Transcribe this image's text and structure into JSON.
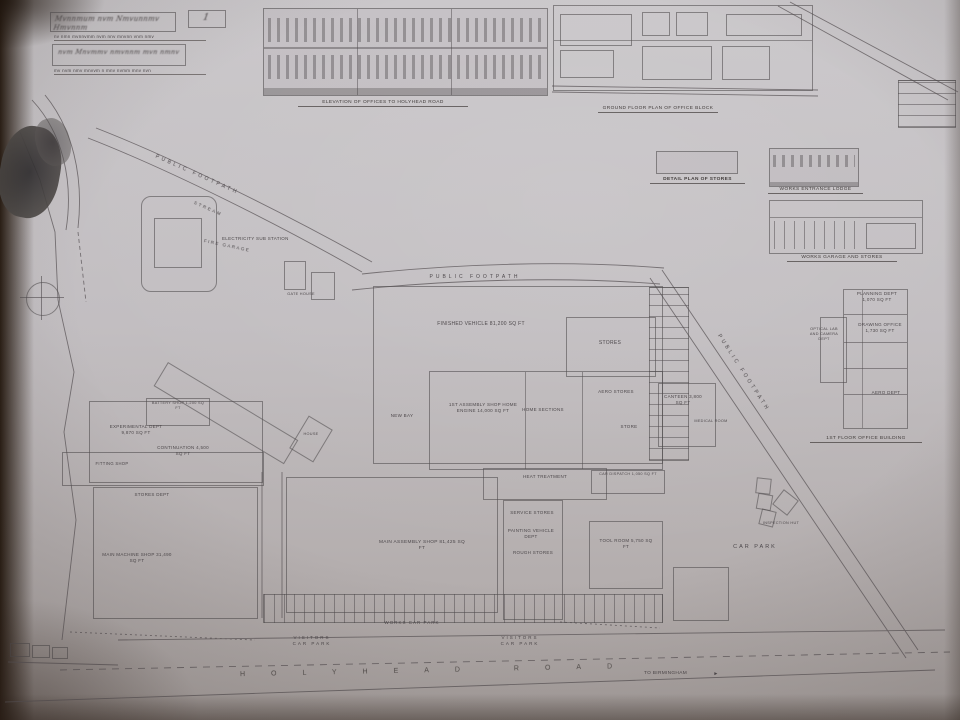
{
  "title_block": {
    "sheet_number": "1",
    "scribble1": "Mvnnmum nvm Nmvunnmv Hmvnnm",
    "typed1": "nv nmn mvnnvmm nvm nnv mnvnn vnm nmv",
    "scribble2": "nvm Mnvmmv nmvnnm mvn nmnv",
    "typed2": "mv nvm nmv mnvvm n mnv nvmm mnv nvn"
  },
  "captions": {
    "elevation": "ELEVATION OF OFFICES TO HOLYHEAD ROAD",
    "ground_plan": "GROUND FLOOR PLAN OF OFFICE BLOCK",
    "stores_shed": "DETAIL PLAN OF STORES",
    "lodge": "WORKS ENTRANCE LODGE",
    "garage": "WORKS GARAGE AND STORES",
    "first_floor": "1ST FLOOR OFFICE BUILDING"
  },
  "right_plan": {
    "planning": "PLANNING DEPT 1,070 SQ FT",
    "drawing_office": "DRAWING OFFICE 1,730 SQ FT",
    "optical": "OPTICAL LAB AND CAMERA DEPT",
    "aero_dept": "AERO DEPT"
  },
  "roads": {
    "holyhead": "HOLYHEAD ROAD",
    "to_birmingham": "TO BIRMINGHAM"
  },
  "paths": {
    "footpath1": "PUBLIC FOOTPATH",
    "footpath2": "PUBLIC FOOTPATH",
    "footpath3": "PUBLIC FOOTPATH",
    "stream": "STREAM"
  },
  "labels": {
    "sub_station": "ELECTRICITY SUB STATION",
    "fire_garage": "FIRE GARAGE",
    "gate_house": "GATE HOUSE",
    "house": "HOUSE",
    "new_bay": "NEW BAY",
    "finished_vehicle": "FINISHED VEHICLE 81,200 SQ FT",
    "stores": "STORES",
    "assembly": "1ST ASSEMBLY SHOP HOME ENGINE 14,000 SQ FT",
    "home_sections": "HOME SECTIONS",
    "aero_stores": "AERO STORES",
    "store": "STORE",
    "canteen": "CANTEEN 3,800 SQ FT",
    "medical": "MEDICAL ROOM",
    "battery": "BATTERY SHOP 1,200 SQ FT",
    "experimental": "EXPERIMENTAL DEPT 9,870 SQ FT",
    "continuation": "CONTINUATION 4,500 SQ FT",
    "fitting": "FITTING SHOP",
    "stores_dept": "STORES DEPT",
    "machine_shop": "MAIN MACHINE SHOP 31,490 SQ FT",
    "main_shop": "MAIN ASSEMBLY SHOP 81,425 SQ FT",
    "heat": "HEAT TREATMENT",
    "service_stores": "SERVICE STORES",
    "painting": "PAINTING VEHICLE DEPT",
    "rough_stores": "ROUGH STORES",
    "car_dispatch": "CAR DISPATCH 1,050 SQ FT",
    "tool_room": "TOOL ROOM 5,750 SQ FT",
    "car_park": "CAR PARK",
    "works_car_park": "WORKS CAR PARK",
    "visitors1": "VISITORS CAR PARK",
    "visitors2": "VISITORS CAR PARK",
    "inspection": "INSPECTION HUT"
  },
  "icons": {
    "arrow_right": "►"
  },
  "colors": {
    "paper": "#c1bdc0",
    "ink": "#524d50",
    "shadow": "#241812"
  }
}
